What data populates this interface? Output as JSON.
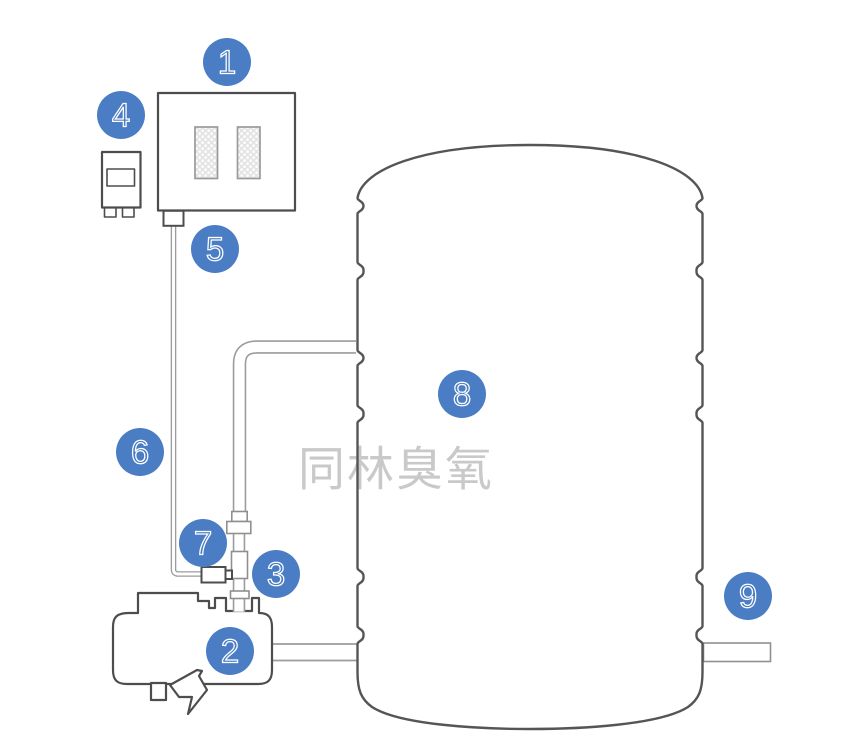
{
  "watermark": {
    "text": "同林臭氧",
    "color": "#c9c9c9"
  },
  "colors": {
    "badge_fill": "#4a7dc4",
    "badge_number_stroke": "#ffffff",
    "outline_gray": "#4d4d4d",
    "tube_gray": "#9c9c9c"
  },
  "badges": [
    {
      "label": "1"
    },
    {
      "label": "2"
    },
    {
      "label": "3"
    },
    {
      "label": "4"
    },
    {
      "label": "5"
    },
    {
      "label": "6"
    },
    {
      "label": "7"
    },
    {
      "label": "8"
    },
    {
      "label": "9"
    }
  ]
}
